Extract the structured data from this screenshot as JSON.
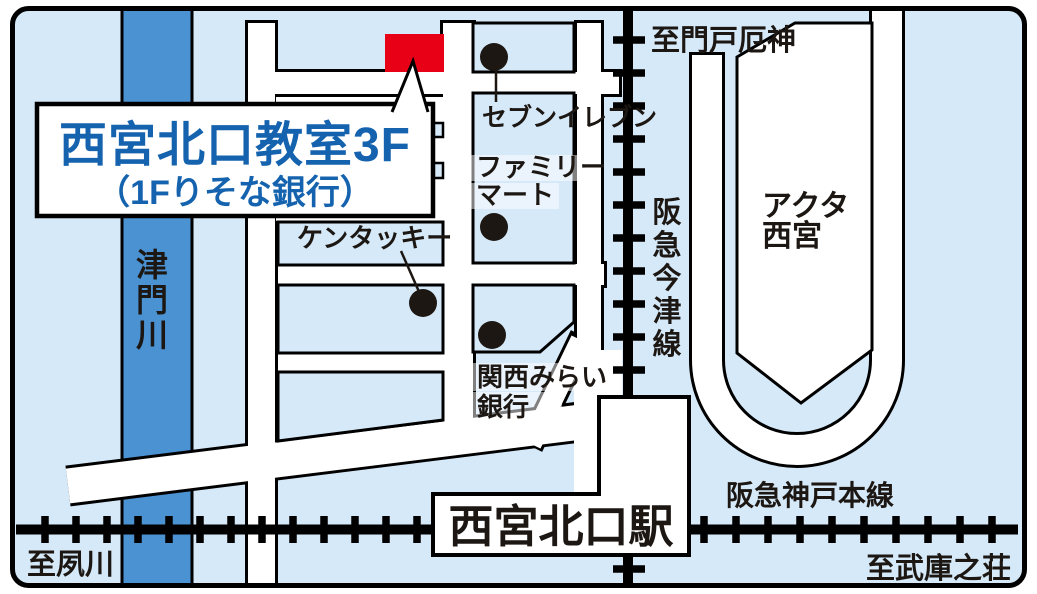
{
  "map": {
    "colors": {
      "background": "#d6e9f8",
      "river": "#4b92d3",
      "marker_red": "#e80017",
      "title_blue": "#1563ae",
      "line_black": "#1c1713"
    },
    "title_box": {
      "line1": "西宮北口教室3F",
      "line2": "（1Fりそな銀行）"
    },
    "pois": {
      "seven_eleven": "セブンイレブン",
      "family_mart_line1": "ファミリー",
      "family_mart_line2": "マート",
      "kentucky": "ケンタッキー",
      "kansai_mirai_line1": "関西みらい",
      "kansai_mirai_line2": "銀行",
      "acta_line1": "アクタ",
      "acta_line2": "西宮",
      "station": "西宮北口駅"
    },
    "river_chars": [
      "津",
      "門",
      "川"
    ],
    "imazu_line_chars": [
      "阪",
      "急",
      "今",
      "津",
      "線"
    ],
    "railways": {
      "kobe_main_line": "阪急神戸本線"
    },
    "directions": {
      "top_right": "至門戸厄神",
      "bottom_left": "至夙川",
      "bottom_right": "至武庫之荘"
    }
  }
}
